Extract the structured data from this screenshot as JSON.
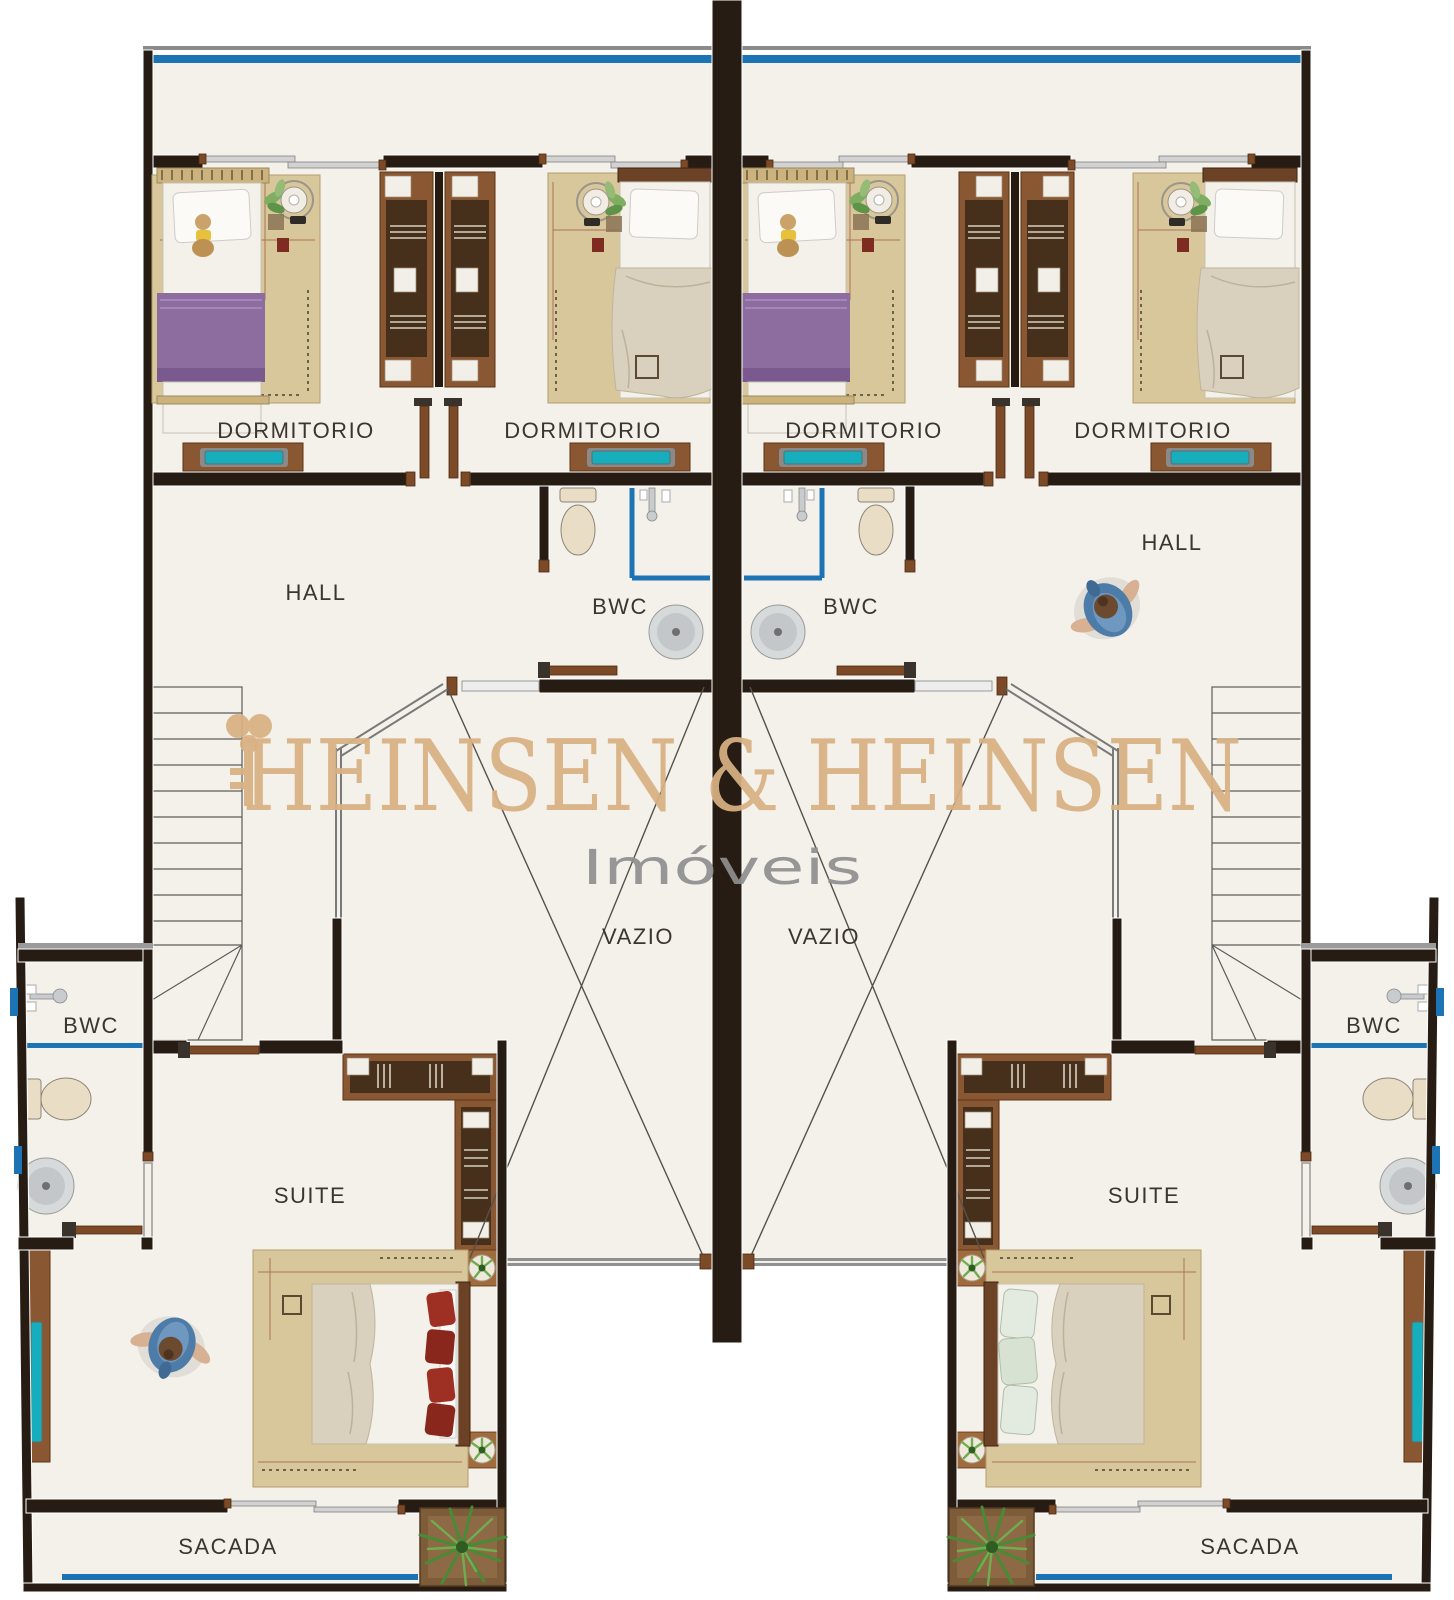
{
  "plan": {
    "watermark": {
      "line1": "HEINSEN & HEINSEN",
      "line2": "Imóveis"
    },
    "rooms": {
      "dormitorio": "DORMITORIO",
      "hall": "HALL",
      "bwc": "BWC",
      "vazio": "VAZIO",
      "suite": "SUITE",
      "sacada": "SACADA"
    },
    "colors": {
      "wall": "#261c13",
      "floor": "#f4f1ea",
      "window_blue": "#1d74b5",
      "desk_teal": "#16aebc",
      "wood": "#7d4a28",
      "bed_purple": "#8d6d9f",
      "bed_beige": "#d9d0bd",
      "pillow_red": "#9e2f23",
      "rug_tan": "#d9c79c",
      "watermark_gold": "#d9b183",
      "watermark_gray": "#8f8f8f",
      "label_text": "#3b352d"
    }
  }
}
